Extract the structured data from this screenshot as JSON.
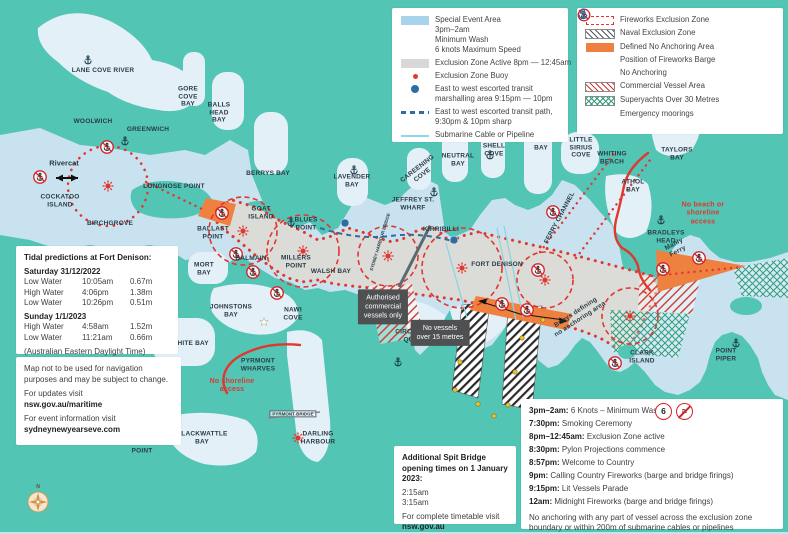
{
  "colors": {
    "land": "#52c5b5",
    "water": "#c9e2f0",
    "exclusion_red": "#e0372e",
    "no_anchoring_orange": "#ef8140",
    "special_event_blue": "#a9d3eb",
    "transit_blue": "#2e6da0"
  },
  "icons": {
    "no_anchoring": "anchor-with-red-slash",
    "fireworks_barge": "red-star-burst",
    "emergency_mooring": "dark-anchor",
    "no_wash": "wave-with-red-slash",
    "speed_limit": "6-in-red-circle",
    "compass_north": "N"
  },
  "legend": {
    "left": [
      {
        "text": "Special Event Area\n3pm–2am\nMinimum Wash\n6 knots Maximum Speed"
      },
      {
        "text": "Exclusion Zone Active 8pm — 12:45am"
      },
      {
        "text": "Exclusion Zone Buoy"
      },
      {
        "text": "East to west escorted transit\nmarshalling area 9:15pm — 10pm"
      },
      {
        "text": "East to west escorted transit path,\n9:30pm & 10pm sharp"
      },
      {
        "text": "Submarine Cable or Pipeline"
      }
    ],
    "right": [
      {
        "text": "Fireworks Exclusion Zone"
      },
      {
        "text": "Naval Exclusion Zone"
      },
      {
        "text": "Defined No Anchoring Area"
      },
      {
        "text": "Position of Fireworks Barge"
      },
      {
        "text": "No Anchoring"
      },
      {
        "text": "Commercial Vessel Area"
      },
      {
        "text": "Superyachts Over 30 Metres"
      },
      {
        "text": "Emergency moorings"
      }
    ]
  },
  "tidal": {
    "title": "Tidal predictions at Fort Denison:",
    "day1": "Saturday 31/12/2022",
    "day1_rows": [
      [
        "Low Water",
        "10:05am",
        "0.67m"
      ],
      [
        "High Water",
        "4:06pm",
        "1.38m"
      ],
      [
        "Low Water",
        "10:26pm",
        "0.51m"
      ]
    ],
    "day2": "Sunday 1/1/2023",
    "day2_rows": [
      [
        "High Water",
        "4:58am",
        "1.52m"
      ],
      [
        "Low Water",
        "11:21am",
        "0.66m"
      ]
    ],
    "note": "(Australian Eastern Daylight Time)"
  },
  "disclaimer": {
    "p1": "Map not to be used for navigation purposes and may be subject to change.",
    "p2a": "For updates visit",
    "p2b": "nsw.gov.au/maritime",
    "p3a": "For event information visit",
    "p3b": "sydneynewyearseve.com"
  },
  "spit": {
    "title": "Additional Spit Bridge opening times on 1 January 2023:",
    "t1": "2:15am",
    "t2": "3:15am",
    "footer1": "For complete timetable visit",
    "footer2": "nsw.gov.au"
  },
  "schedule": {
    "speed_icon_label": "6",
    "items": [
      {
        "time": "3pm–2am:",
        "text": "6 Knots – Minimum Wash"
      },
      {
        "time": "7:30pm:",
        "text": "Smoking Ceremony"
      },
      {
        "time": "8pm–12:45am:",
        "text": "Exclusion Zone active"
      },
      {
        "time": "8:30pm:",
        "text": "Pylon Projections commence"
      },
      {
        "time": "8:57pm:",
        "text": "Welcome to Country"
      },
      {
        "time": "9pm:",
        "text": "Calling Country Fireworks (barge and bridge firings)"
      },
      {
        "time": "9:15pm:",
        "text": "Lit Vessels Parade"
      },
      {
        "time": "12am:",
        "text": "Midnight Fireworks (barge and bridge firings)"
      }
    ],
    "note": "No anchoring with any part of vessel across the exclusion zone boundary or within 200m of submarine cables or pipelines"
  },
  "labels": [
    "LANE COVE RIVER",
    "WOOLWICH",
    "GREENWICH",
    "GORE\nCOVE\nBAY",
    "BALLS\nHEAD\nBAY",
    "Rivercat",
    "COCKATOO\nISLAND",
    "LONGNOSE POINT",
    "BIRCHGROVE",
    "BALLAST\nPOINT",
    "MORT\nBAY",
    "GOAT\nISLAND",
    "BALMAIN",
    "MILLERS\nPOINT",
    "WALSH BAY",
    "BLUES\nPOINT",
    "BERRYS BAY",
    "LAVENDER\nBAY",
    "JEFFREY ST.\nWHARF",
    "KIRRIBILLI",
    "CAREENING\nCOVE",
    "NEUTRAL\nBAY",
    "SHELL\nCOVE",
    "MOSMAN\nBAY",
    "LITTLE\nSIRIUS\nCOVE",
    "WHITING\nBEACH",
    "TAYLORS\nBAY",
    "ATHOL\nBAY",
    "BRADLEYS\nHEAD",
    "FERRY CHANNEL",
    "FORT DENISON",
    "SYDNEY HARBOUR BRIDGE",
    "JOHNSTONS\nBAY",
    "NAWI\nCOVE",
    "WHITE BAY",
    "PYRMONT\nWHARVES",
    "CIRCULAR\nQUAY",
    "CLARK\nISLAND",
    "POINT\nPIPER",
    "ANZAC BRIDGE",
    "ROZELLE BAY",
    "GLEBE\nPOINT",
    "BLACKWATTLE\nBAY",
    "PYRMONT BRIDGE",
    "DARLING\nHARBOUR",
    "Buoys defining\nno anchoring area",
    "No beach or\nshoreline\naccess",
    "No shoreline\naccess",
    "Manly\nFerry",
    "Authorised\ncommercial\nvessels only",
    "No vessels\nover 15 metres"
  ]
}
